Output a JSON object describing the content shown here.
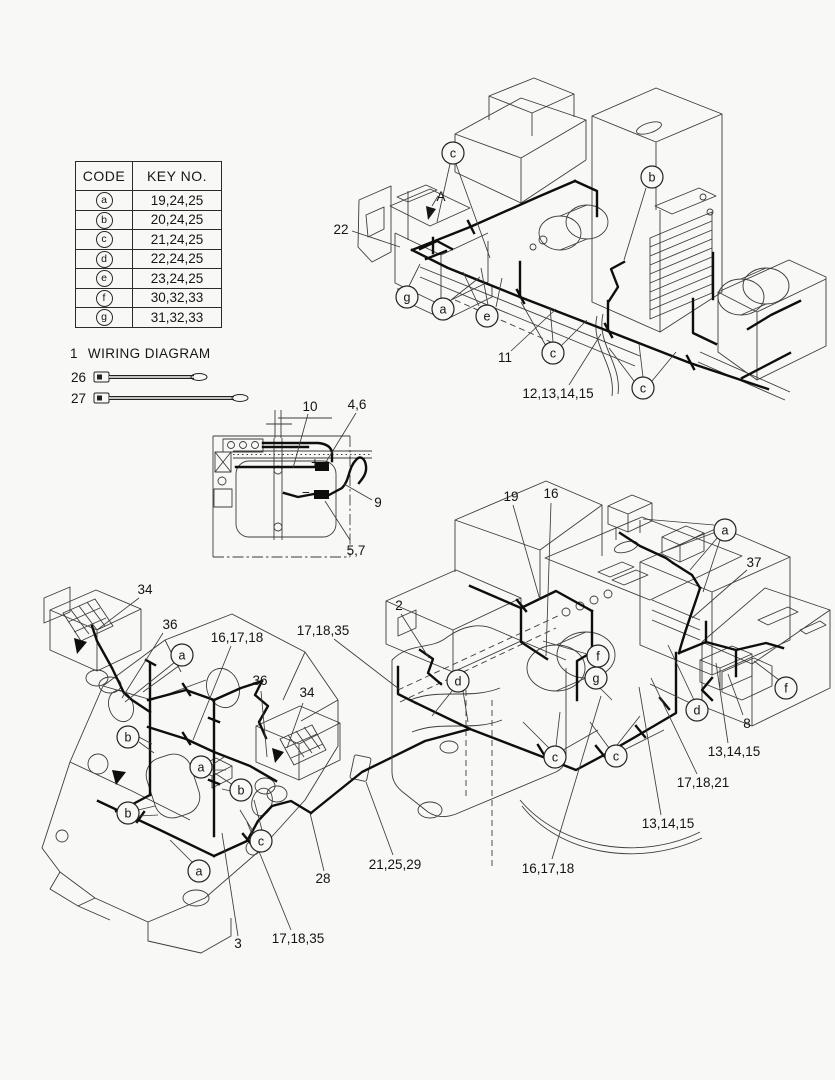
{
  "colors": {
    "background": "#f8f8f6",
    "ink": "#141414",
    "line_art": "#3c3c3c"
  },
  "key_table": {
    "headers": [
      "CODE",
      "KEY NO."
    ],
    "rows": [
      {
        "code": "a",
        "key_no": "19,24,25"
      },
      {
        "code": "b",
        "key_no": "20,24,25"
      },
      {
        "code": "c",
        "key_no": "21,24,25"
      },
      {
        "code": "d",
        "key_no": "22,24,25"
      },
      {
        "code": "e",
        "key_no": "23,24,25"
      },
      {
        "code": "f",
        "key_no": "30,32,33"
      },
      {
        "code": "g",
        "key_no": "31,32,33"
      }
    ]
  },
  "legend": {
    "item_no": "1",
    "title": "WIRING DIAGRAM",
    "parts": {
      "no26": "26",
      "no27": "27"
    }
  },
  "diagram": {
    "labels": [
      {
        "t": "22",
        "x": 341,
        "y": 234
      },
      {
        "t": "A",
        "x": 441,
        "y": 201,
        "size": 16,
        "name": "view-arrow-label"
      },
      {
        "t": "11",
        "x": 505,
        "y": 362
      },
      {
        "t": "12,13,14,15",
        "x": 558,
        "y": 398
      },
      {
        "t": "10",
        "x": 310,
        "y": 411
      },
      {
        "t": "4,6",
        "x": 357,
        "y": 409
      },
      {
        "t": "9",
        "x": 378,
        "y": 507
      },
      {
        "t": "5,7",
        "x": 356,
        "y": 555
      },
      {
        "t": "+",
        "x": 315,
        "y": 467,
        "size": 12,
        "name": "plus-terminal-label"
      },
      {
        "t": "−",
        "x": 306,
        "y": 497,
        "size": 12,
        "name": "minus-terminal-label"
      },
      {
        "t": "34",
        "x": 145,
        "y": 594
      },
      {
        "t": "36",
        "x": 170,
        "y": 629
      },
      {
        "t": "16,17,18",
        "x": 237,
        "y": 642
      },
      {
        "t": "36",
        "x": 260,
        "y": 685
      },
      {
        "t": "34",
        "x": 307,
        "y": 697
      },
      {
        "t": "28",
        "x": 323,
        "y": 883
      },
      {
        "t": "3",
        "x": 238,
        "y": 948
      },
      {
        "t": "17,18,35",
        "x": 298,
        "y": 943
      },
      {
        "t": "19",
        "x": 511,
        "y": 501
      },
      {
        "t": "16",
        "x": 551,
        "y": 498
      },
      {
        "t": "37",
        "x": 754,
        "y": 567
      },
      {
        "t": "2",
        "x": 399,
        "y": 610
      },
      {
        "t": "17,18,35",
        "x": 323,
        "y": 635
      },
      {
        "t": "8",
        "x": 747,
        "y": 728
      },
      {
        "t": "13,14,15",
        "x": 734,
        "y": 756
      },
      {
        "t": "17,18,21",
        "x": 703,
        "y": 787
      },
      {
        "t": "13,14,15",
        "x": 668,
        "y": 828
      },
      {
        "t": "16,17,18",
        "x": 548,
        "y": 873
      },
      {
        "t": "21,25,29",
        "x": 395,
        "y": 869
      }
    ],
    "callouts": [
      {
        "letter": "c",
        "x": 453,
        "y": 153
      },
      {
        "letter": "b",
        "x": 652,
        "y": 177
      },
      {
        "letter": "g",
        "x": 407,
        "y": 297
      },
      {
        "letter": "a",
        "x": 443,
        "y": 309
      },
      {
        "letter": "e",
        "x": 487,
        "y": 316
      },
      {
        "letter": "c",
        "x": 553,
        "y": 353
      },
      {
        "letter": "c",
        "x": 643,
        "y": 388
      },
      {
        "letter": "a",
        "x": 725,
        "y": 530
      },
      {
        "letter": "f",
        "x": 598,
        "y": 656
      },
      {
        "letter": "g",
        "x": 596,
        "y": 678
      },
      {
        "letter": "d",
        "x": 458,
        "y": 681
      },
      {
        "letter": "d",
        "x": 697,
        "y": 710
      },
      {
        "letter": "f",
        "x": 786,
        "y": 688
      },
      {
        "letter": "c",
        "x": 555,
        "y": 757
      },
      {
        "letter": "c",
        "x": 616,
        "y": 756
      },
      {
        "letter": "a",
        "x": 182,
        "y": 655
      },
      {
        "letter": "b",
        "x": 128,
        "y": 737
      },
      {
        "letter": "a",
        "x": 201,
        "y": 767
      },
      {
        "letter": "b",
        "x": 241,
        "y": 790
      },
      {
        "letter": "b",
        "x": 128,
        "y": 813
      },
      {
        "letter": "c",
        "x": 261,
        "y": 841
      },
      {
        "letter": "a",
        "x": 199,
        "y": 871
      }
    ]
  }
}
